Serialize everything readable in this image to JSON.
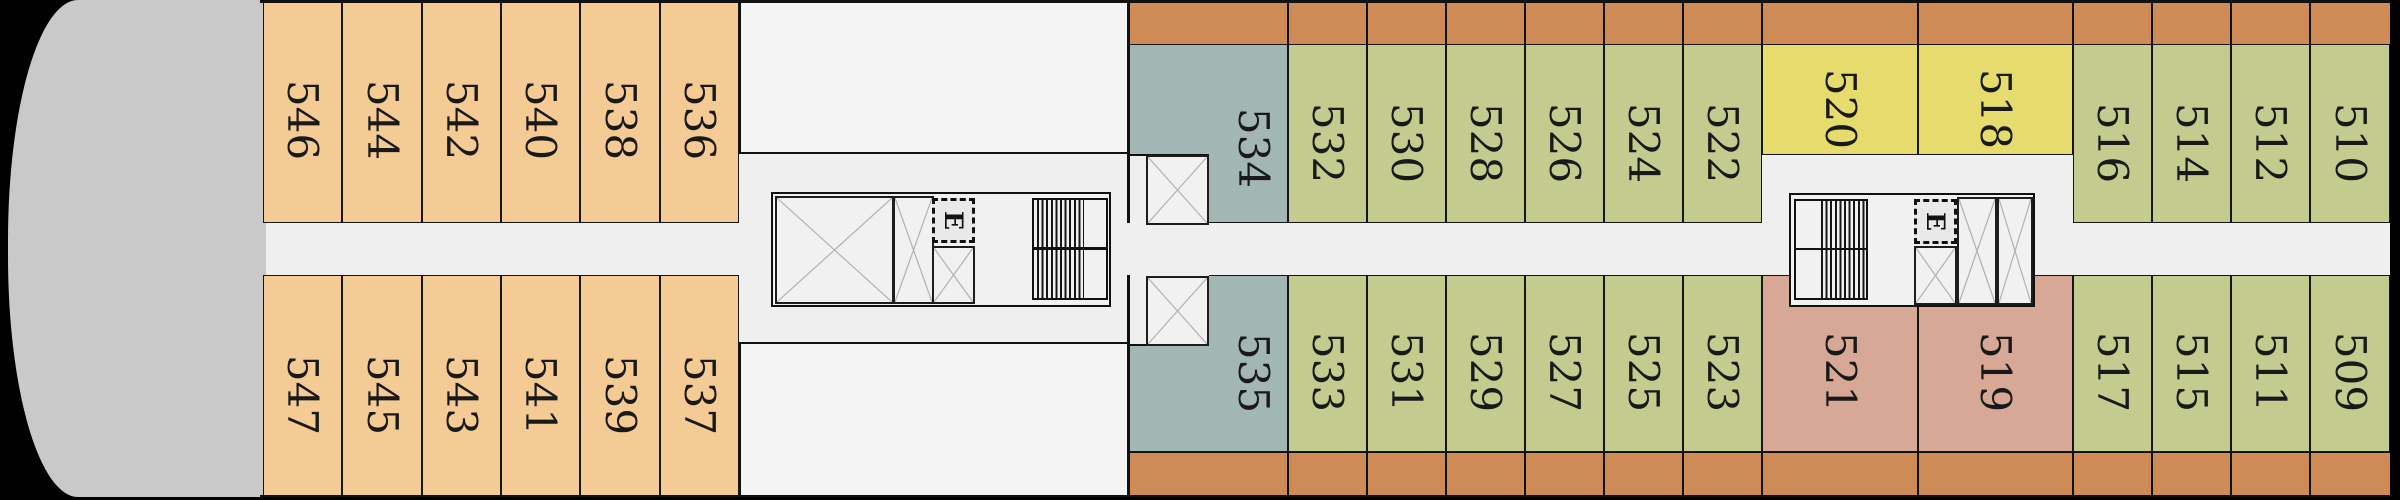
{
  "palette": {
    "background": "#000000",
    "floor": "#efefef",
    "structure_block": "#f4f4f4",
    "bow": "#c9c9c9",
    "balcony_strip": "#cf8b56",
    "cabin_tan": "#f4cb94",
    "cabin_green": "#c3cb8e",
    "cabin_teal": "#a2b7b4",
    "cabin_yellow": "#e5dc6d",
    "cabin_pink": "#d8a896",
    "wall_line": "#111111",
    "shaft_fill": "#f1f1f1",
    "shaft_cross": "#b1b1b1",
    "elevator_fill": "#e9e9e9"
  },
  "cabins": {
    "top_row": [
      {
        "num": "546",
        "type": "tan"
      },
      {
        "num": "544",
        "type": "tan"
      },
      {
        "num": "542",
        "type": "tan"
      },
      {
        "num": "540",
        "type": "tan"
      },
      {
        "num": "538",
        "type": "tan"
      },
      {
        "num": "536",
        "type": "tan"
      },
      {
        "num": "534",
        "type": "teal"
      },
      {
        "num": "532",
        "type": "green"
      },
      {
        "num": "530",
        "type": "green"
      },
      {
        "num": "528",
        "type": "green"
      },
      {
        "num": "526",
        "type": "green"
      },
      {
        "num": "524",
        "type": "green"
      },
      {
        "num": "522",
        "type": "green"
      },
      {
        "num": "520",
        "type": "yellow"
      },
      {
        "num": "518",
        "type": "yellow"
      },
      {
        "num": "516",
        "type": "green"
      },
      {
        "num": "514",
        "type": "green"
      },
      {
        "num": "512",
        "type": "green"
      },
      {
        "num": "510",
        "type": "green"
      }
    ],
    "bottom_row": [
      {
        "num": "547",
        "type": "tan"
      },
      {
        "num": "545",
        "type": "tan"
      },
      {
        "num": "543",
        "type": "tan"
      },
      {
        "num": "541",
        "type": "tan"
      },
      {
        "num": "539",
        "type": "tan"
      },
      {
        "num": "537",
        "type": "tan"
      },
      {
        "num": "535",
        "type": "teal"
      },
      {
        "num": "533",
        "type": "green"
      },
      {
        "num": "531",
        "type": "green"
      },
      {
        "num": "529",
        "type": "green"
      },
      {
        "num": "527",
        "type": "green"
      },
      {
        "num": "525",
        "type": "green"
      },
      {
        "num": "523",
        "type": "green"
      },
      {
        "num": "521",
        "type": "pink"
      },
      {
        "num": "519",
        "type": "pink"
      },
      {
        "num": "517",
        "type": "green"
      },
      {
        "num": "515",
        "type": "green"
      },
      {
        "num": "511",
        "type": "green"
      },
      {
        "num": "509",
        "type": "green"
      }
    ]
  },
  "core": {
    "elevator_label": "E"
  }
}
